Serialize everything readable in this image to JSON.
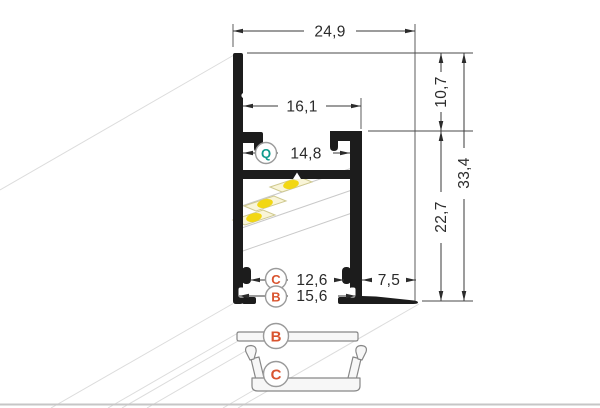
{
  "drawing": {
    "dimensions": {
      "top_width": "24,9",
      "inner_width": "16,1",
      "q_slot_width": "14,8",
      "top_depth": "10,7",
      "total_height": "33,4",
      "body_height": "22,7",
      "c_slot_width": "12,6",
      "b_slot_width": "15,6",
      "flange_width": "7,5"
    },
    "labels": {
      "q": "Q",
      "c": "C",
      "b": "B"
    },
    "covers": {
      "b_label": "B",
      "c_label": "C"
    },
    "colors": {
      "profile_black": "#1c1c1c",
      "teal_accent": "#0e9b8d",
      "orange_accent": "#d9542f",
      "dimension_line": "#3a3a3a",
      "perspective_line": "#dcdcdc",
      "led_yellow": "#f2d713",
      "led_chip_body": "#f9f5d8"
    }
  }
}
